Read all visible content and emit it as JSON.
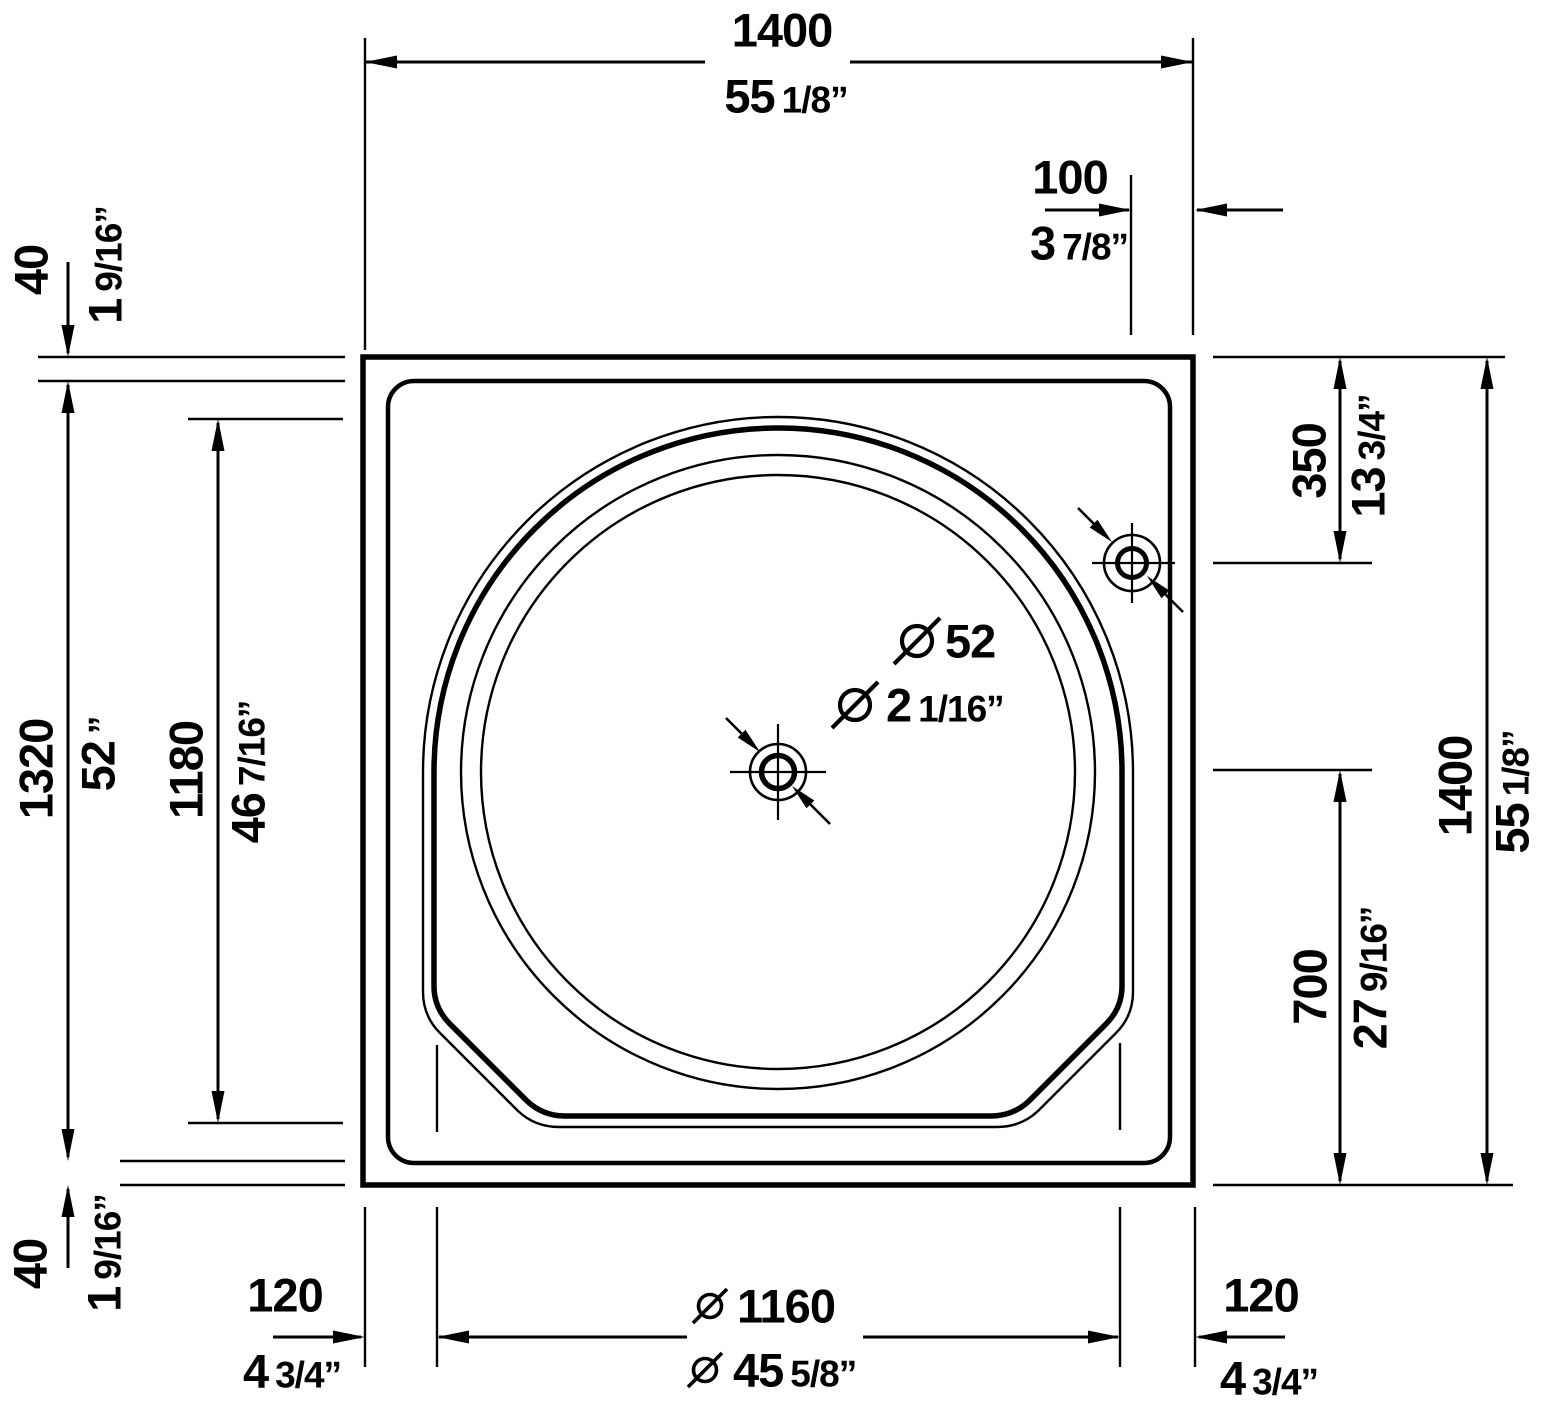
{
  "drawing_type": "bathtub-top-view-dimension-drawing",
  "units": {
    "primary": "mm",
    "secondary": "inch"
  },
  "dims": {
    "overall_width": {
      "mm": "1400",
      "in_w": "55",
      "in_f": "1/8”"
    },
    "jet_edge_offset": {
      "mm": "100",
      "in_w": "3",
      "in_f": "7/8”"
    },
    "rim_top": {
      "mm": "40",
      "in_w": "1",
      "in_f": "9/16”"
    },
    "inner_width": {
      "mm": "1320",
      "in_w": "52",
      "in_f": "”"
    },
    "basin_extent": {
      "mm": "1180",
      "in_w": "46",
      "in_f": "7/16”"
    },
    "rim_bottom": {
      "mm": "40",
      "in_w": "1",
      "in_f": "9/16”"
    },
    "jet_top_offset": {
      "mm": "350",
      "in_w": "13",
      "in_f": "3/4”"
    },
    "overall_height": {
      "mm": "1400",
      "in_w": "55",
      "in_f": "1/8”"
    },
    "drain_bottom_offset": {
      "mm": "700",
      "in_w": "27",
      "in_f": "9/16”"
    },
    "ledge_left": {
      "mm": "120",
      "in_w": "4",
      "in_f": "3/4”"
    },
    "basin_diameter": {
      "mm": "1160",
      "in_w": "45",
      "in_f": "5/8”"
    },
    "ledge_right": {
      "mm": "120",
      "in_w": "4",
      "in_f": "3/4”"
    },
    "drain_diameter": {
      "mm": "52",
      "in_w": "2",
      "in_f": "1/16”"
    }
  }
}
